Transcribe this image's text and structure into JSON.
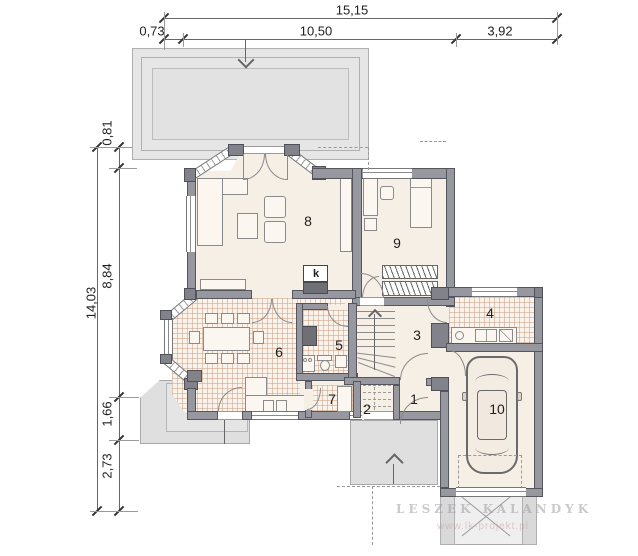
{
  "dimensions": {
    "top": {
      "total": "15,15",
      "seg1": "0,73",
      "seg2": "10,50",
      "seg3": "3,92"
    },
    "left": {
      "total": "14,03",
      "seg1": "0,81",
      "seg2": "8,84",
      "seg3": "1,66",
      "seg4": "2,73"
    }
  },
  "rooms": {
    "r1": "1",
    "r2": "2",
    "r3": "3",
    "r4": "4",
    "r5": "5",
    "r6": "6",
    "r7": "7",
    "r8": "8",
    "r9": "9",
    "r10": "10"
  },
  "labels": {
    "fireplace": "k"
  },
  "watermark": {
    "line1": "LESZEK KALANDYK",
    "line2": "www.lk-projekt.pl"
  },
  "colors": {
    "wall": "#97979f",
    "floor": "#f6efe6",
    "tile_floor": "#faf3ec",
    "terrace": "#e6e6e6",
    "porch": "#dfdfdf",
    "line": "#555555"
  }
}
